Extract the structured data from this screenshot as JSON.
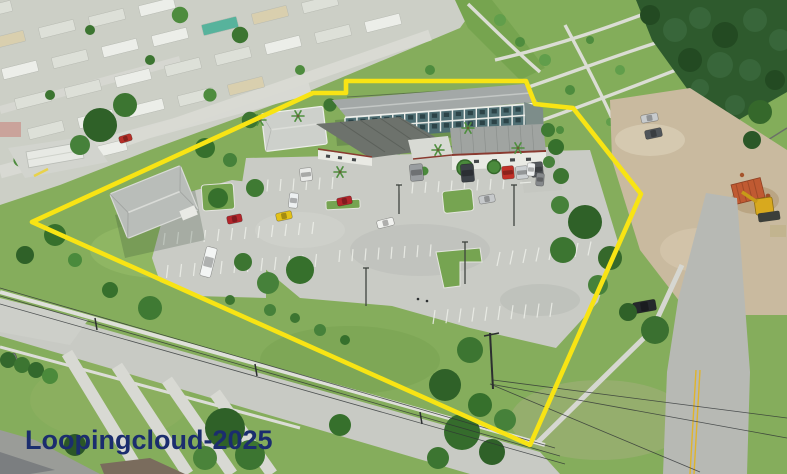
{
  "image": {
    "type": "aerial-drone-photograph",
    "subject": "apartment complex property outlined in yellow, mobile home park to the northwest, public park to the northeast",
    "width": 787,
    "height": 474
  },
  "watermark": {
    "text": "Loopingcloud-2025",
    "color": "#1b2d6e",
    "x": "25",
    "y": "449",
    "font_size": "27"
  },
  "boundary": {
    "color": "#f8e414",
    "stroke_width": "4.6",
    "points_svg": "32,222 313,93 346,93 346,81 526,81 535,104 573,108 641,194 530,445"
  },
  "palette": {
    "grass": "#85ad5c",
    "pavement": "#c9cbc5",
    "roof_gray": "#a3a8a7",
    "facade_teal": "#4f6f74",
    "trim_red": "#8a3a30",
    "dirt": "#c9ba9f",
    "forest": "#2e5a2d",
    "road": "#b7b9b4",
    "container_orange": "#c05a32",
    "excavator_yellow": "#d8a91e"
  },
  "objects": {
    "cars": [
      {
        "name": "white-car-front-row",
        "color": "#e9eae8",
        "x": 300,
        "y": 168,
        "w": 12,
        "h": 13,
        "rot": -6
      },
      {
        "name": "gray-van-front-row",
        "color": "#999da0",
        "x": 410,
        "y": 164,
        "w": 13,
        "h": 17,
        "rot": -5
      },
      {
        "name": "dark-suv-front-row",
        "color": "#3c4147",
        "x": 461,
        "y": 164,
        "w": 13,
        "h": 18,
        "rot": -5
      },
      {
        "name": "red-car-front-row",
        "color": "#c23028",
        "x": 502,
        "y": 166,
        "w": 12,
        "h": 13,
        "rot": -5
      },
      {
        "name": "silver-car-front-row",
        "color": "#ccd0d2",
        "x": 516,
        "y": 166,
        "w": 12,
        "h": 13,
        "rot": -5
      },
      {
        "name": "dark-car-front-row",
        "color": "#53575b",
        "x": 531,
        "y": 162,
        "w": 12,
        "h": 15,
        "rot": -5
      },
      {
        "name": "red-car-mid-lot",
        "color": "#b3252b",
        "x": 337,
        "y": 197,
        "w": 15,
        "h": 8,
        "rot": -12
      },
      {
        "name": "white-car-mid-lot",
        "color": "#f1f2ef",
        "x": 377,
        "y": 219,
        "w": 17,
        "h": 8,
        "rot": -14
      },
      {
        "name": "silver-car-mid-lot",
        "color": "#c6c9cb",
        "x": 479,
        "y": 195,
        "w": 16,
        "h": 8,
        "rot": -10
      },
      {
        "name": "red-car-west-lot",
        "color": "#b3252b",
        "x": 227,
        "y": 215,
        "w": 15,
        "h": 8,
        "rot": -12
      },
      {
        "name": "yellow-car-west-lot",
        "color": "#e3c219",
        "x": 276,
        "y": 212,
        "w": 16,
        "h": 8,
        "rot": -12
      },
      {
        "name": "white-suv-west-lot",
        "color": "#edf0f1",
        "x": 289,
        "y": 193,
        "w": 9,
        "h": 15,
        "rot": 6
      },
      {
        "name": "white-box-truck",
        "color": "#f3f5f4",
        "x": 203,
        "y": 247,
        "w": 11,
        "h": 30,
        "rot": 14
      },
      {
        "name": "white-car-east-drive",
        "color": "#eef0f0",
        "x": 527,
        "y": 163,
        "w": 8,
        "h": 13,
        "rot": 4
      },
      {
        "name": "gray-car-east-drive",
        "color": "#85888b",
        "x": 536,
        "y": 173,
        "w": 8,
        "h": 13,
        "rot": 4
      },
      {
        "name": "silver-car-dirt-lot",
        "color": "#c8cbcd",
        "x": 641,
        "y": 114,
        "w": 17,
        "h": 8,
        "rot": -10
      },
      {
        "name": "dark-car-dirt-lot",
        "color": "#50555a",
        "x": 645,
        "y": 129,
        "w": 17,
        "h": 9,
        "rot": -12
      },
      {
        "name": "black-car-roadside",
        "color": "#25282c",
        "x": 633,
        "y": 301,
        "w": 23,
        "h": 11,
        "rot": -10
      },
      {
        "name": "red-car-nw-street",
        "color": "#b62f28",
        "x": 119,
        "y": 135,
        "w": 13,
        "h": 7,
        "rot": -17
      },
      {
        "name": "gray-car-bottom-left",
        "color": "#75797d",
        "x": 1,
        "y": 355,
        "w": 16,
        "h": 9,
        "rot": -20
      },
      {
        "name": "white-car-bottom-edge",
        "color": "#e8e9e9",
        "x": 12,
        "y": 466,
        "w": 14,
        "h": 8,
        "rot": -18
      }
    ],
    "shipping_container": {
      "color": "#c05a32",
      "x": 733,
      "y": 181,
      "w": 30,
      "h": 20,
      "rot": -14
    },
    "excavator": {
      "color": "#d8a91e",
      "x": 762,
      "y": 203
    }
  }
}
